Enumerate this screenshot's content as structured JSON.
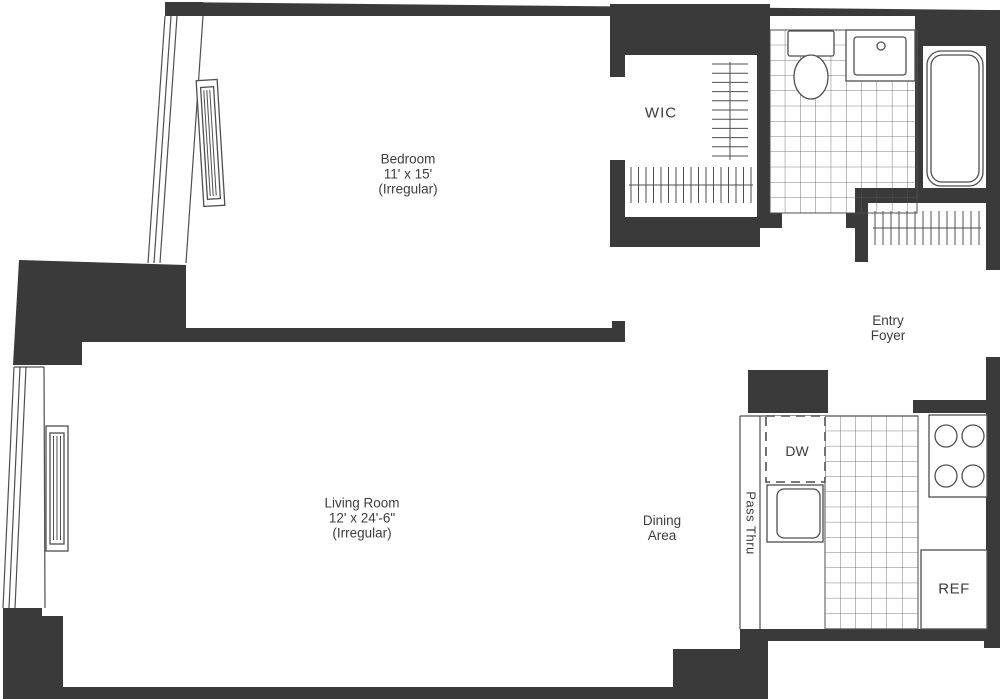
{
  "plan": {
    "bedroom": {
      "name": "Bedroom",
      "dims": "11' x 15'",
      "note": "(Irregular)"
    },
    "living_room": {
      "name": "Living Room",
      "dims": "12' x 24'-6\"",
      "note": "(Irregular)"
    },
    "wic": {
      "name": "WIC"
    },
    "dining": {
      "line1": "Dining",
      "line2": "Area"
    },
    "entry": {
      "line1": "Entry",
      "line2": "Foyer"
    },
    "kitchen": {
      "dw": "DW",
      "ref": "REF",
      "pass_thru": "Pass Thru"
    },
    "colors": {
      "wall": "#3a3a3a",
      "line": "#4f4f4f",
      "text": "#3d3d3d",
      "background": "#ffffff"
    }
  }
}
